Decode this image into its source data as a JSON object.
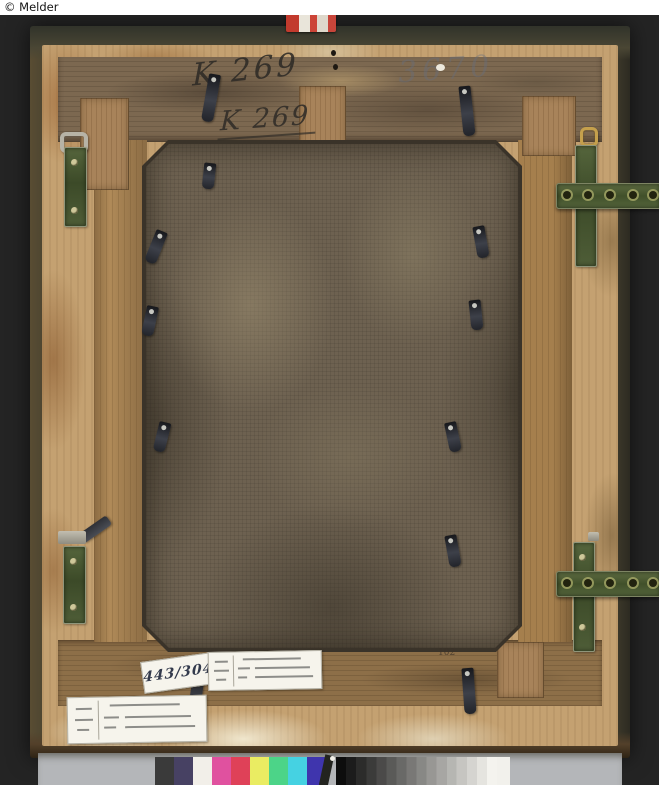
{
  "copyright": {
    "text": "© Melder"
  },
  "inscriptions": {
    "k269_upper": "K 269",
    "k269_lower": "K 269",
    "faint_number": "3670",
    "corner_number": "102"
  },
  "labels": {
    "handwritten_number": "443/304"
  },
  "color_bar": {
    "patches": [
      "#3a3a3a",
      "#474163",
      "#f2efe9",
      "#e0519f",
      "#df4158",
      "#eaec62",
      "#4cd488",
      "#45d2e2",
      "#3f35ad"
    ],
    "grayscale_from": "#0d0d0d",
    "grayscale_to": "#f4f3ee",
    "grayscale_steps": 16
  },
  "palette": {
    "background": "#242424",
    "copyright_bg": "#ffffff",
    "frame_outer": "#46412f",
    "frame_back": "#c4a171",
    "stretcher_wood": "#8a6b48",
    "canvas": "#6d6150",
    "hardware_green": "#4e5d37",
    "mount_gray": "#b4b6b9"
  }
}
